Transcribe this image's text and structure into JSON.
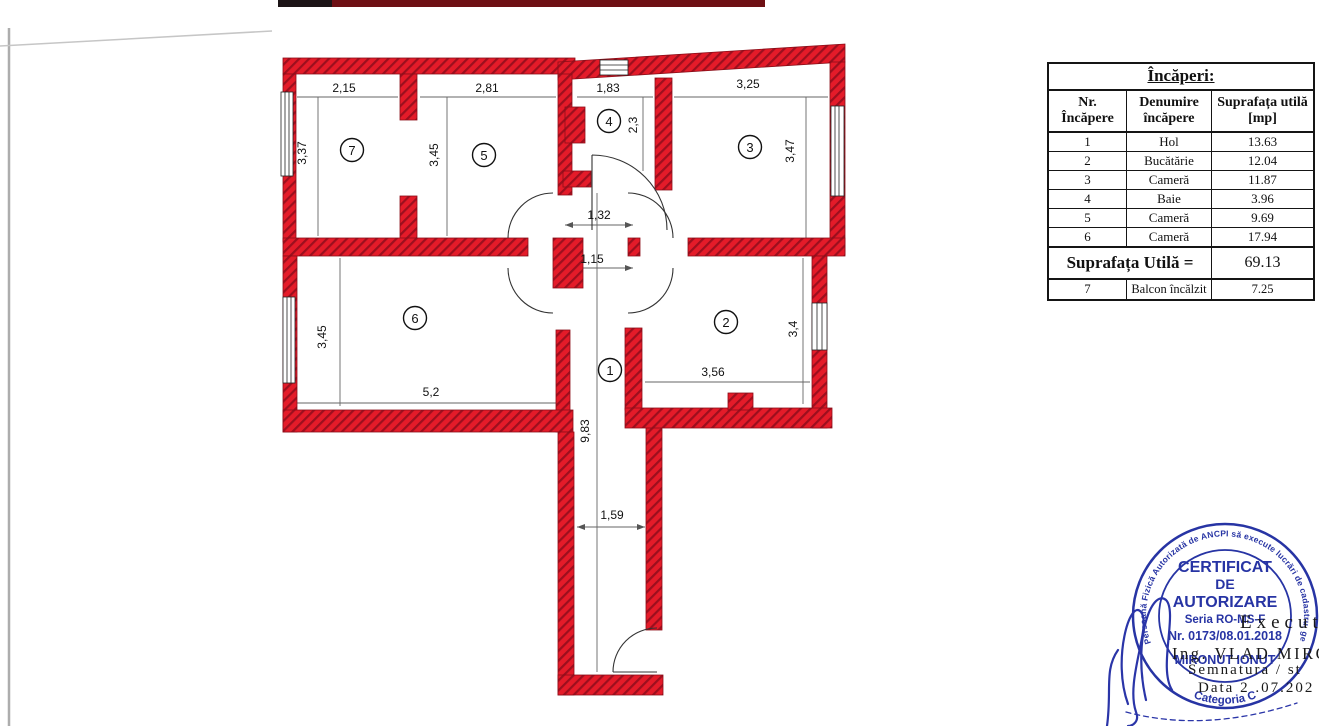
{
  "table": {
    "title": "Încăperi:",
    "col1": "Nr. Încăpere",
    "col2": "Denumire încăpere",
    "col3": "Suprafața utilă [mp]",
    "rows": [
      [
        "1",
        "Hol",
        "13.63"
      ],
      [
        "2",
        "Bucătărie",
        "12.04"
      ],
      [
        "3",
        "Cameră",
        "11.87"
      ],
      [
        "4",
        "Baie",
        "3.96"
      ],
      [
        "5",
        "Cameră",
        "9.69"
      ],
      [
        "6",
        "Cameră",
        "17.94"
      ]
    ],
    "total_label": "Suprafața Utilă =",
    "total_value": "69.13",
    "row7": [
      "7",
      "Balcon încălzit",
      "7.25"
    ]
  },
  "plan": {
    "wall_color": "#e41b29",
    "wall_hatch_color": "#9c0f1e",
    "rooms": [
      {
        "number": "7"
      },
      {
        "number": "5"
      },
      {
        "number": "4"
      },
      {
        "number": "3"
      },
      {
        "number": "6"
      },
      {
        "number": "2"
      },
      {
        "number": "1"
      }
    ],
    "dims": [
      {
        "label": "2,15"
      },
      {
        "label": "2,81"
      },
      {
        "label": "1,83"
      },
      {
        "label": "3,25"
      },
      {
        "label": "3,37"
      },
      {
        "label": "3,45"
      },
      {
        "label": "2,3"
      },
      {
        "label": "3,47"
      },
      {
        "label": "1,32"
      },
      {
        "label": "1,15"
      },
      {
        "label": "3,45"
      },
      {
        "label": "5,2"
      },
      {
        "label": "3,56"
      },
      {
        "label": "3,4"
      },
      {
        "label": "9,83"
      },
      {
        "label": "1,59"
      }
    ]
  },
  "stamp": {
    "color": "#2734a4",
    "ring_text": "Persoană Fizică Autorizată de ANCPI să execute lucrări de cadastru, geodezie și cartografie",
    "line1": "CERTIFICAT",
    "line2": "DE",
    "line3": "AUTORIZARE",
    "line4": "Seria RO-MS-F",
    "line5": "Nr. 0173/08.01.2018",
    "line6": "MIRONUT IONUT",
    "categoria": "Categoria C"
  },
  "overlay": {
    "executant": "Executant",
    "name": "Ing. VLAD MIRONUT",
    "semnatura": "Semnatura / st",
    "data": "Data 2 .07.202"
  }
}
